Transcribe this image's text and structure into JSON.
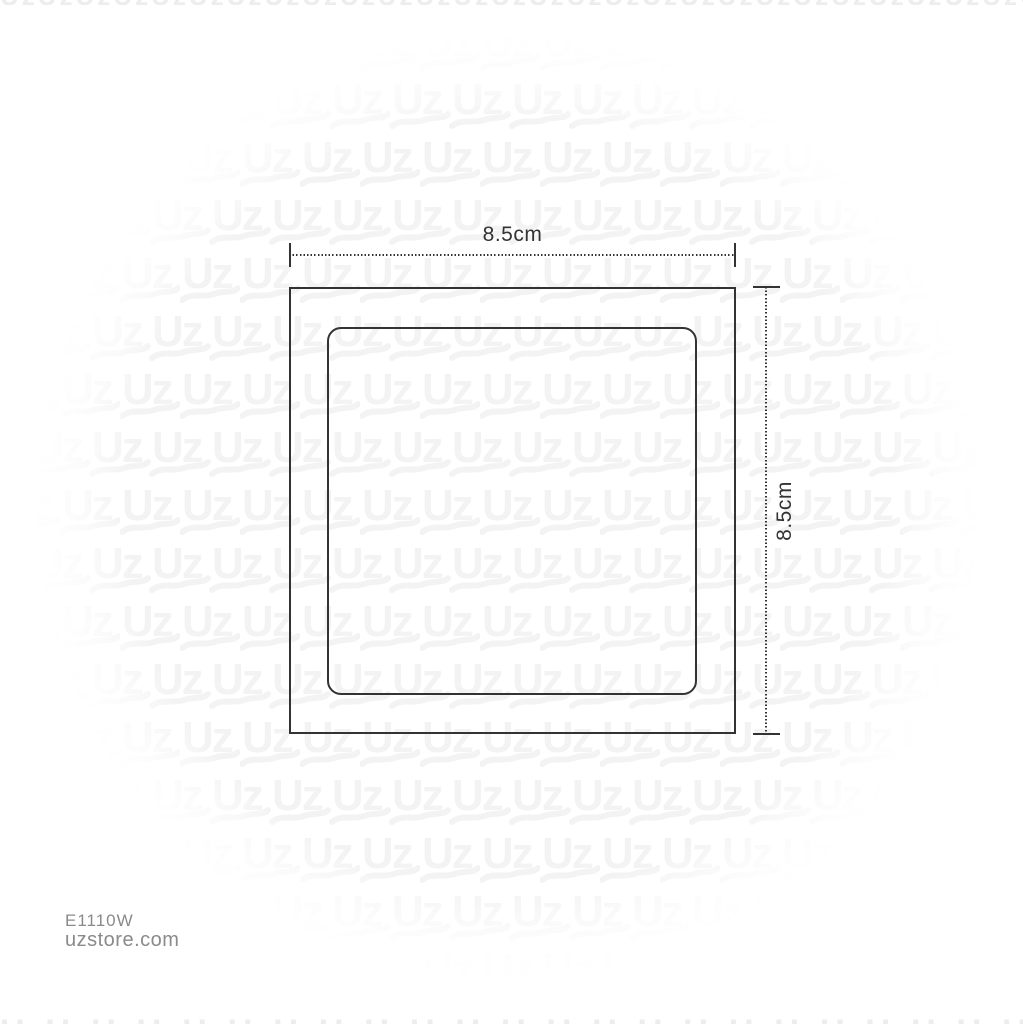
{
  "diagram": {
    "width_label": "8.5cm",
    "height_label": "8.5cm"
  },
  "footer": {
    "product_code": "E1110W",
    "website": "uzstore.com"
  },
  "watermark": {
    "text": "Uz",
    "color": "#f3f3f3"
  },
  "colors": {
    "line": "#333333",
    "dimension_text": "#333333",
    "footer_text": "#8a8a8a",
    "edge_glyphs": "#ededed",
    "background": "#ffffff"
  }
}
